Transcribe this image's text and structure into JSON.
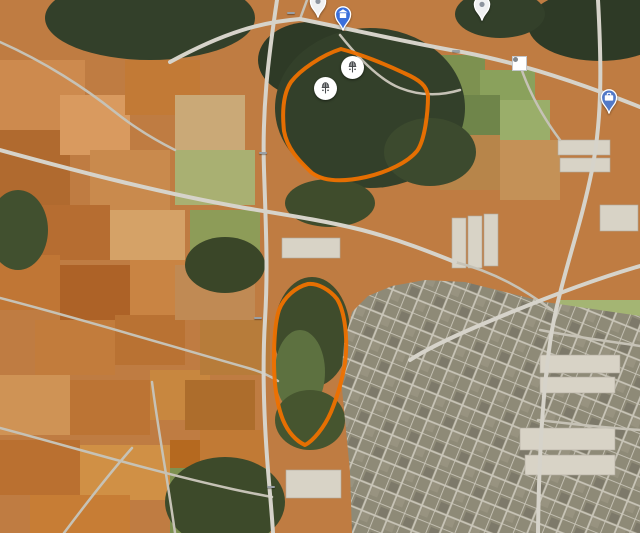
{
  "map": {
    "palette": {
      "region_outline": "#ee7100",
      "label_white": "#ffffff",
      "label_green": "#a9dcab",
      "pin_blue": "#5279c7",
      "pin_teal": "#12b0c5",
      "pin_green": "#2f9e4f",
      "pin_amber": "#e8a33d",
      "pin_slate": "#7e8b99",
      "pin_shrine_blue": "#3a6fdb"
    },
    "shield_text": "中75",
    "shields": [
      {
        "x": 291,
        "y": 13
      },
      {
        "x": 456,
        "y": 51
      },
      {
        "x": 263,
        "y": 153
      },
      {
        "x": 258,
        "y": 318
      },
      {
        "x": 271,
        "y": 487
      }
    ],
    "streams": [
      {
        "text": "竹林南溪",
        "x": 18,
        "y": 150,
        "rot": 50
      },
      {
        "text": "竹林南溪",
        "x": 294,
        "y": 130,
        "rot": 4
      },
      {
        "text": "竹林南溪",
        "x": 512,
        "y": 150,
        "rot": -16
      }
    ],
    "road_names": [
      {
        "text": "東大路二段911巷",
        "x": 558,
        "y": 305,
        "rot": -21
      }
    ],
    "labels": [
      {
        "lines": [
          "中華天然聖道會"
        ],
        "x": 518,
        "y": 40,
        "color": "white",
        "align": "center"
      },
      {
        "lines": [
          "六順汽車(詠順汽車)"
        ],
        "x": 566,
        "y": 76,
        "color": "white",
        "align": "left"
      },
      {
        "lines": [
          "喬山健康科技",
          "股份有限公司"
        ],
        "x": 597,
        "y": 126,
        "color": "white",
        "align": "center"
      },
      {
        "lines": [
          "研恆科技股份有限公司"
        ],
        "x": 564,
        "y": 176,
        "color": "white",
        "align": "left"
      },
      {
        "lines": [
          "天台砂石股份有限公司"
        ],
        "x": 563,
        "y": 223,
        "color": "white",
        "align": "left"
      },
      {
        "lines": [
          "昱伸鐵架帆布行"
        ],
        "x": 560,
        "y": 251,
        "color": "white",
        "align": "left"
      },
      {
        "lines": [
          "順捷股份有限公司"
        ],
        "x": 565,
        "y": 291,
        "color": "white",
        "align": "left"
      },
      {
        "lines": [
          "生有企業"
        ],
        "x": 606,
        "y": 362,
        "color": "white",
        "align": "left"
      },
      {
        "lines": [
          "海通寺"
        ],
        "x": 501,
        "y": 258,
        "color": "white",
        "align": "center"
      },
      {
        "lines": [
          "金東林林木",
          "處理有限公司"
        ],
        "x": 287,
        "y": 232,
        "color": "white",
        "align": "center"
      },
      {
        "lines": [
          "台中月老廟夜景"
        ],
        "x": 158,
        "y": 184,
        "color": "white",
        "align": "center"
      },
      {
        "lines": [
          "星海棧農場"
        ],
        "x": 103,
        "y": 208,
        "color": "white",
        "align": "center"
      },
      {
        "lines": [
          "親子部落-月老祠"
        ],
        "x": 162,
        "y": 286,
        "color": "white",
        "align": "center"
      },
      {
        "lines": [
          "九天黑森林"
        ],
        "x": 41,
        "y": 313,
        "color": "green",
        "align": "center"
      },
      {
        "lines": [
          "黑森林景觀咖啡"
        ],
        "x": 83,
        "y": 364,
        "color": "white",
        "align": "center"
      },
      {
        "lines": [
          "尊航",
          "雅..."
        ],
        "x": -6,
        "y": 371,
        "color": "white",
        "align": "left"
      },
      {
        "lines": [
          "九天民俗技藝團"
        ],
        "x": 237,
        "y": 417,
        "color": "white",
        "align": "center"
      },
      {
        "lines": [
          "天宮太子",
          "子景觀園"
        ],
        "x": 264,
        "y": 331,
        "color": "white",
        "align": "left"
      },
      {
        "lines": [
          "懷親園(真耶穌",
          "教會南台中教會)"
        ],
        "x": 371,
        "y": 353,
        "color": "white",
        "align": "left"
      },
      {
        "lines": [
          "雨生園"
        ],
        "x": 393,
        "y": 386,
        "color": "green",
        "align": "center"
      },
      {
        "lines": [
          "懷恩園(真耶穌",
          "教會南台中教會)"
        ],
        "x": 289,
        "y": 425,
        "color": "white",
        "align": "left"
      },
      {
        "lines": [
          "大度山寶塔"
        ],
        "x": 572,
        "y": 353,
        "color": "green",
        "align": "center"
      },
      {
        "lines": [
          "大度山花園公墓、寶塔"
        ],
        "x": 516,
        "y": 399,
        "color": "green",
        "align": "center"
      },
      {
        "lines": [
          "大度山墓園壽",
          "九區市府路"
        ],
        "x": 427,
        "y": 430,
        "color": "green",
        "align": "left"
      },
      {
        "lines": [
          "萊爾富中區物流中心"
        ],
        "x": 551,
        "y": 411,
        "color": "white",
        "align": "center"
      },
      {
        "lines": [
          "大東寶展業"
        ],
        "x": 588,
        "y": 428,
        "color": "white",
        "align": "left"
      },
      {
        "lines": [
          "大銘汽車貨運",
          "股份有限公司"
        ],
        "x": 545,
        "y": 481,
        "color": "white",
        "align": "center"
      },
      {
        "lines": [
          "題陞企業有限公司"
        ],
        "x": 568,
        "y": 511,
        "color": "white",
        "align": "left"
      },
      {
        "lines": [
          "私立先施花園公墓"
        ],
        "x": 346,
        "y": 505,
        "color": "green",
        "align": "center"
      },
      {
        "lines": [
          "九天霞光之樹"
        ],
        "x": 110,
        "y": 505,
        "color": "white",
        "align": "center"
      }
    ],
    "markers": [
      {
        "kind": "gray-pin",
        "x": 318,
        "y": 1
      },
      {
        "kind": "shrine-pin",
        "x": 343,
        "y": 14
      },
      {
        "kind": "gray-pin",
        "x": 482,
        "y": 4
      },
      {
        "kind": "dot-circle",
        "x": 518,
        "y": 62
      },
      {
        "kind": "temple-circle",
        "x": 352,
        "y": 67
      },
      {
        "kind": "temple-circle",
        "x": 325,
        "y": 88
      },
      {
        "kind": "blue-pin",
        "x": 609,
        "y": 97
      },
      {
        "kind": "fdc-circle",
        "x": 366,
        "y": 134,
        "label": "FDC"
      },
      {
        "kind": "temple-circle",
        "x": 346,
        "y": 141
      },
      {
        "kind": "blue-pin",
        "x": 598,
        "y": 160
      },
      {
        "kind": "temple-circle",
        "x": 318,
        "y": 166
      },
      {
        "kind": "gray-pin",
        "x": 101,
        "y": 192
      },
      {
        "kind": "blue-pin",
        "x": 599,
        "y": 197
      },
      {
        "kind": "teal-camera-pin",
        "x": 157,
        "y": 204
      },
      {
        "kind": "blue-pin",
        "x": 555,
        "y": 229
      },
      {
        "kind": "blue-pin",
        "x": 285,
        "y": 267
      },
      {
        "kind": "blue-pin",
        "x": 595,
        "y": 273
      },
      {
        "kind": "swastika-circle",
        "x": 512,
        "y": 282
      },
      {
        "kind": "temple-circle",
        "x": 318,
        "y": 302
      },
      {
        "kind": "teal-camera-pin",
        "x": 161,
        "y": 308
      },
      {
        "kind": "blue-pin",
        "x": 603,
        "y": 313
      },
      {
        "kind": "green-flower-pin",
        "x": 41,
        "y": 336
      },
      {
        "kind": "temple-circle",
        "x": 334,
        "y": 343
      },
      {
        "kind": "slate-building-pin",
        "x": 301,
        "y": 363
      },
      {
        "kind": "slate-building-pin",
        "x": 359,
        "y": 360
      },
      {
        "kind": "green-tree-pin",
        "x": 568,
        "y": 374
      },
      {
        "kind": "temple-circle",
        "x": 313,
        "y": 375
      },
      {
        "kind": "fdc-circle",
        "x": 328,
        "y": 383,
        "label": "FDC"
      },
      {
        "kind": "amber-coffee-pin",
        "x": 82,
        "y": 389
      },
      {
        "kind": "green-tree-pin",
        "x": 452,
        "y": 401
      },
      {
        "kind": "green-tree-pin",
        "x": 364,
        "y": 411
      },
      {
        "kind": "temple-circle",
        "x": 313,
        "y": 419
      },
      {
        "kind": "white-pin",
        "x": 549,
        "y": 433
      },
      {
        "kind": "teal-mask-pin",
        "x": 239,
        "y": 438
      },
      {
        "kind": "blue-pin",
        "x": 630,
        "y": 452
      },
      {
        "kind": "green-tree-pin",
        "x": 326,
        "y": 457
      },
      {
        "kind": "green-tree-pin",
        "x": 456,
        "y": 464
      },
      {
        "kind": "white-pin",
        "x": 573,
        "y": 469
      },
      {
        "kind": "white-pin",
        "x": 528,
        "y": 517
      },
      {
        "kind": "restaurant-circle",
        "x": 269,
        "y": 522
      },
      {
        "kind": "teal-camera-pin",
        "x": 107,
        "y": 525
      },
      {
        "kind": "green-tree-pin",
        "x": 345,
        "y": 527
      }
    ]
  }
}
